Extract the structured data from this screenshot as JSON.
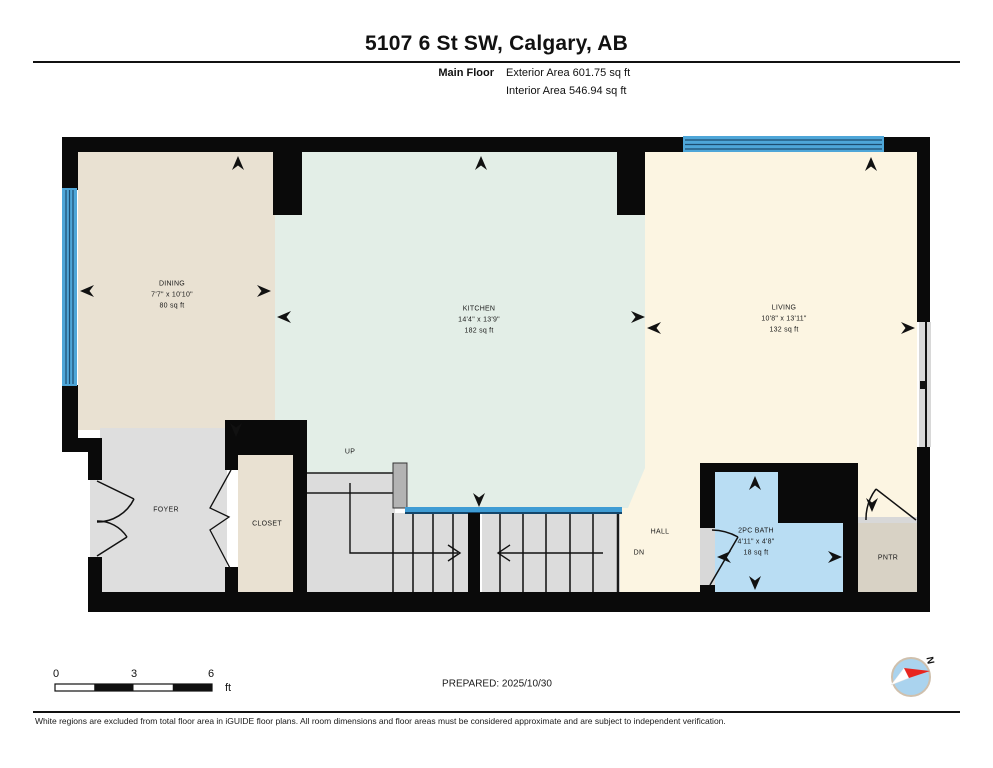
{
  "header": {
    "title": "5107 6 St SW, Calgary, AB",
    "floor_label": "Main Floor",
    "exterior_area": "Exterior Area 601.75 sq ft",
    "interior_area": "Interior Area 546.94 sq ft"
  },
  "rooms": {
    "dining": {
      "name": "DINING",
      "dimensions": "7'7\" x 10'10\"",
      "area": "80 sq ft"
    },
    "kitchen": {
      "name": "KITCHEN",
      "dimensions": "14'4\" x 13'9\"",
      "area": "182 sq ft"
    },
    "living": {
      "name": "LIVING",
      "dimensions": "10'8\" x 13'11\"",
      "area": "132 sq ft"
    },
    "bath": {
      "name": "2PC BATH",
      "dimensions": "4'11\" x 4'8\"",
      "area": "18 sq ft"
    },
    "foyer": {
      "name": "FOYER"
    },
    "closet": {
      "name": "CLOSET"
    },
    "hall": {
      "name": "HALL"
    },
    "pantry": {
      "name": "PNTR"
    }
  },
  "stairs": {
    "up_label": "UP",
    "down_label": "DN"
  },
  "footer": {
    "scale_ticks": [
      "0",
      "3",
      "6"
    ],
    "scale_unit": "ft",
    "prepared": "PREPARED: 2025/10/30",
    "compass_north": "N",
    "disclaimer": "White regions are excluded from total floor area in iGUIDE floor plans. All room dimensions and floor areas must be considered approximate and are subject to independent verification."
  },
  "colors": {
    "wall": "#0a0a0a",
    "dining_floor": "#e9e1d2",
    "kitchen_floor": "#e3eee7",
    "living_floor": "#fcf5e2",
    "foyer_floor": "#dedede",
    "bath_floor": "#b9ddf3",
    "pantry_floor": "#d8d2c5",
    "stairs_floor": "#dcdcdc",
    "window": "#4ea6d8",
    "railing": "#3f9cd4",
    "compass_red": "#e8251f",
    "compass_blue": "#aad3ee"
  }
}
